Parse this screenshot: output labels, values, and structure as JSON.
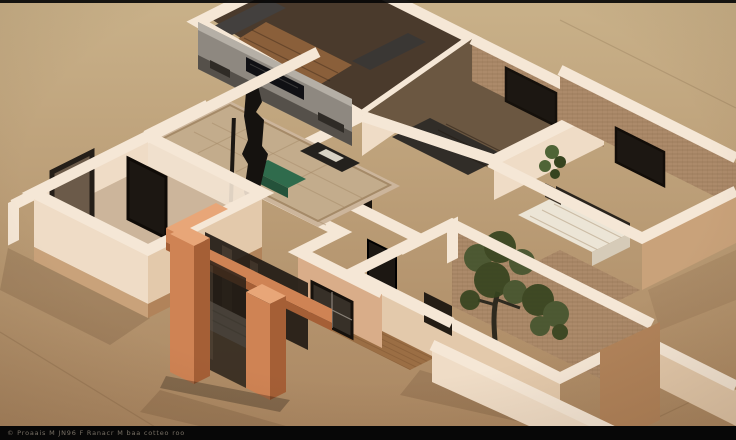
{
  "meta": {
    "caption": "3D isometric cutaway model of an apartment floor plan viewed from above on a tan background",
    "image_kind": "architectural render"
  },
  "watermark": {
    "text": "© Proaais M JN96 F Ranacr M baa cotteo roo"
  },
  "palette": {
    "bg_top": "#c9b189",
    "bg_bottom": "#aa8661",
    "wall_top": "#f5e7d6",
    "wall_face_light": "#efdcc6",
    "wall_face_shade": "#e3c9ab",
    "wall_face_dark": "#c9a27a",
    "wall_face_deep": "#b1835a",
    "wall_peach": "#d9ad89",
    "brick": "#ac8a6a",
    "brick_line": "#8d6d50",
    "floor_beige": "#ccb59b",
    "rug": "#c3ac8c",
    "rug_line": "#a58a68",
    "wood": "#9b6e44",
    "wood_line": "#7c5331",
    "media_wall": "#8e8880",
    "media_top": "#b5afa6",
    "media_dark": "#55504a",
    "tv_black": "#101014",
    "dark_frame": "#1c1712",
    "dark_furniture": "#24211d",
    "glass": "#221b15",
    "green_table": "#2f6b4c",
    "green_dark": "#24523a",
    "terracotta": "#cf8354",
    "terracotta_dark": "#a55f36",
    "terracotta_light": "#e8a678",
    "bed_white": "#ece5d6",
    "bed_shade": "#d6cbb8",
    "closet_wood": "#8a5f3a",
    "closet_dark": "#43403e",
    "foliage": "#46552f",
    "foliage_dark": "#36441f",
    "trunk": "#2e2a1f",
    "plant": "#4f6436",
    "bar_black": "#070707",
    "watermark": "#8b8275"
  },
  "scene": {
    "background": {
      "top": "#c9b189",
      "bottom": "#aa8661"
    },
    "elements": [
      {
        "name": "wardrobe-room",
        "label": "top room with dark wardrobe and wood closet",
        "color": "#8a5f3a"
      },
      {
        "name": "living-room",
        "label": "living room with media wall, black sculpture, green coffee table and rug",
        "color": "#c3ac8c"
      },
      {
        "name": "bedroom-left",
        "label": "left bedroom with white bed and dark door frames",
        "color": "#ece5d6"
      },
      {
        "name": "bedroom-right",
        "label": "right bedroom with textured brick walls and dark window",
        "color": "#ac8a6a"
      },
      {
        "name": "bedroom-far-right",
        "label": "far-right bedroom with brick wall, window, patterned bed and plant",
        "color": "#ac8a6a"
      },
      {
        "name": "hallway-bath",
        "label": "central hallway / bathroom block with small dark windows",
        "color": "#d9ad89"
      },
      {
        "name": "entry-porch",
        "label": "terracotta entry porch with glass panels and pillars",
        "color": "#cf8354"
      },
      {
        "name": "tree-courtyard",
        "label": "courtyard with tree against brick wall",
        "color": "#46552f"
      },
      {
        "name": "wood-deck",
        "label": "wooden courtyard floor with steps",
        "color": "#9b6e44"
      }
    ]
  }
}
